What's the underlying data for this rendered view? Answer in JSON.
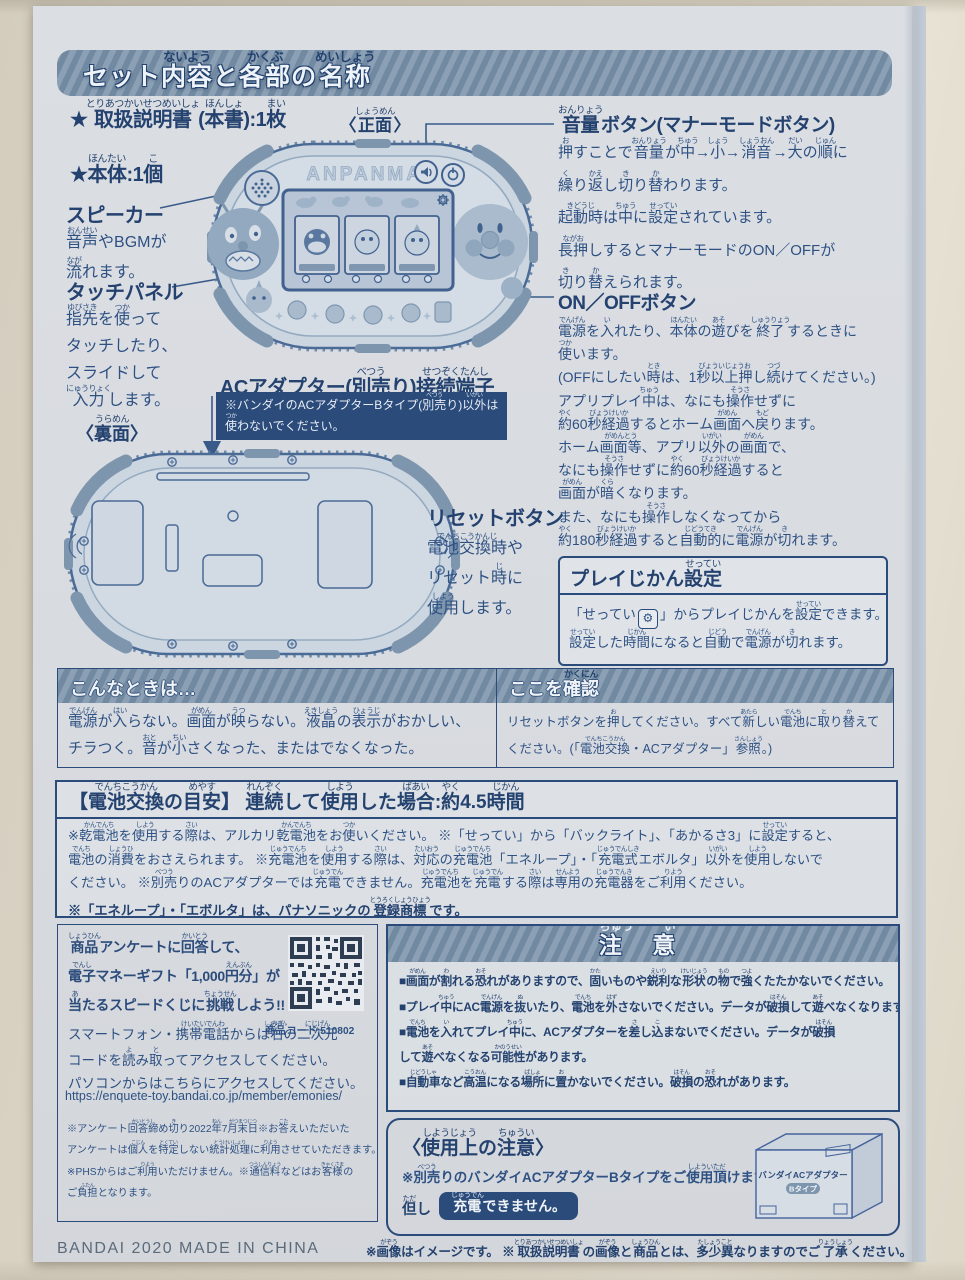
{
  "colors": {
    "paper": "#dbdee3",
    "ink": "#2e5183",
    "ink_dark": "#24426f",
    "bar_blue": "#7e95ab",
    "navy_box": "#2b4b7b",
    "photo_bg": "#ddd6c7"
  },
  "header": {
    "title": "セット{内容|ないよう}と{各部|かくぶ}の{名称|めいしょう}"
  },
  "contents": {
    "item1": "★{取扱説明書|とりあつかいせつめいしょ}({本書|ほんしょ}):1{枚|まい}",
    "item2": "★{本体|ほんたい}:1{個|こ}"
  },
  "front": {
    "caption": "〈{正面|しょうめん}〉",
    "logo": "ANPANMAN"
  },
  "speaker": {
    "label": "スピーカー",
    "desc": "{音声|おんせい}やBGMが\n{流|なが}れます。"
  },
  "touch": {
    "label": "タッチパネル",
    "desc": "{指先|ゆびさき}を{使|つか}って\nタッチしたり、\nスライドして\n{入力|にゅうりょく}します。"
  },
  "ac": {
    "label": "ACアダプター({別売|べつう}り){接続端子|せつぞくたんし}",
    "note": "※バンダイのACアダプターBタイプ({別売|べつう}り){以外|いがい}は\n{使|つか}わないでください。"
  },
  "back": {
    "caption": "〈{裏面|うらめん}〉"
  },
  "reset": {
    "label": "リセットボタン",
    "desc": "{電池交換時|でんちこうかんじ}や\nリセット{時|じ}に\n{使用|しよう}します。"
  },
  "volume": {
    "label": "{音量|おんりょう}ボタン(マナーモードボタン)",
    "desc": "{押|お}すことで{音量|おんりょう}が{中|ちゅう}→{小|しょう}→{消音|しょうおん}→{大|だい}の{順|じゅん}に\n{繰|く}り{返|かえ}し{切|き}り{替|か}わります。\n{起動時|きどうじ}は{中|ちゅう}に{設定|せってい}されています。\n{長押|ながお}しするとマナーモードのON／OFFが\n{切|き}り{替|か}えられます。"
  },
  "power": {
    "label": "ON／OFFボタン",
    "desc": "{電源|でんげん}を{入|い}れたり、{本体|ほんたい}の{遊|あそ}びを{終了|しゅうりょう}するときに\n{使|つか}います。\n(OFFにしたい{時|とき}は、1{秒以上押|びょういじょうお}し{続|つづ}けてください。)\nアプリプレイ{中|ちゅう}は、なにも{操作|そうさ}せずに\n{約|やく}60{秒経過|びょうけいか}するとホーム{画面|がめん}へ{戻|もど}ります。\nホーム{画面等|がめんとう}、アプリ{以外|いがい}の{画面|がめん}で、\nなにも{操作|そうさ}せずに{約|やく}60{秒経過|びょうけいか}すると\n{画面|がめん}が{暗|くら}くなります。\nまた、なにも{操作|そうさ}しなくなってから\n{約|やく}180{秒経過|びょうけいか}すると{自動的|じどうてき}に{電源|でんげん}が{切|き}れます。"
  },
  "playtime": {
    "title": "プレイじかん{設定|せってい}",
    "line1_pre": "「せってい",
    "gear_icon": "⚙",
    "line1_post": "」からプレイじかんを{設定|せってい}できます。",
    "line2": "{設定|せってい}した{時間|じかん}になると{自動|じどう}で{電源|でんげん}が{切|き}れます。"
  },
  "trouble": {
    "title": "こんなときは…",
    "body": "{電源|でんげん}が{入|はい}らない。{画面|がめん}が{映|うつ}らない。{液晶|えきしょう}の{表示|ひょうじ}がおかしい、\nチラつく。{音|おと}が{小|ちい}さくなった、またはでなくなった。"
  },
  "check": {
    "title": "ここを{確認|かくにん}",
    "body": "リセットボタンを{押|お}してください。すべて{新|あたら}しい{電池|でんち}に{取|と}り{替|か}えて\nください。(「{電池交換|でんちこうかん}・ACアダプター」{参照|さんしょう}。)"
  },
  "battery": {
    "title": "【{電池交換|でんちこうかん}の{目安|めやす}】 {連続|れんぞく}して{使用|しよう}した{場合|ばあい}:{約|やく}4.5{時間|じかん}",
    "body": "※{乾電池|かんでんち}を{使用|しよう}する{際|さい}は、アルカリ{乾電池|かんでんち}をお{使|つか}いください。 ※「せってい」から「バックライト」、「あかるさ3」に{設定|せってい}すると、\n{電池|でんち}の{消費|しょうひ}をおさえられます。 ※{充電池|じゅうでんち}を{使用|しよう}する{際|さい}は、{対応|たいおう}の{充電池|じゅうでんち}「エネループ」・「{充電式|じゅうでんしき}エボルタ」{以外|いがい}を{使用|しよう}しないで\nください。 ※{別売|べつう}りのACアダプターでは{充電|じゅうでん}できません。{充電池|じゅうでんち}を{充電|じゅうでん}する{際|さい}は{専用|せんよう}の{充電器|じゅうでんき}をご{利用|りよう}ください。",
    "note": "※「エネループ」・「エボルタ」は、パナソニックの{登録商標|とうろくしょうひょう}です。"
  },
  "survey": {
    "line1": "{商品|しょうひん}アンケートに{回答|かいとう}して、",
    "line2": "{電子|でんし}マネーギフト「1,000{円分|えんぶん}」が",
    "line3": "{当|あ}たるスピードくじに{挑戦|ちょうせん}しよう!!",
    "line4": "スマートフォン・{携帯電話|けいたいでんわ}からは{右|みぎ}の{二次元|にじげん}",
    "line5": "コードを{読|よ}み{取|と}ってアクセスしてください。",
    "line6": "パソコンからはこちらにアクセスしてください。",
    "url": "https://enquete-toy.bandai.co.jp/member/emonies/",
    "note1": "※アンケート{回答締|かいとうし}め{切|き}り2022{年|ねん}7{月末日|がつまつじつ}※お{答|こた}えいただいた",
    "note2": "アンケートは{個人|こじん}を{特定|とくてい}しない{統計処理|とうけいしょり}に{利用|りよう}させていただきます。",
    "note3": "※PHSからはご{利用|りよう}いただけません。※{通信料|つうしんりょう}などはお{客様|きゃくさま}の",
    "note4": "ご{負担|ふたん}となります。",
    "product_code": "{商品|しょうひん}コード:510802"
  },
  "caution": {
    "title": "{注|ちゅう} {意|い}",
    "item1": "■{画面|がめん}が{割|わ}れる{恐|おそ}れがありますので、{固|かた}いものや{鋭利|えいり}な{形状|けいじょう}の{物|もの}で{強|つよ}くたたかないでください。",
    "item2": "■プレイ{中|ちゅう}にAC{電源|でんげん}を{抜|ぬ}いたり、{電池|でんち}を{外|はず}さないでください。データが{破損|はそん}して{遊|あそ}べなくなります。",
    "item3": "■{電池|でんち}を{入|い}れてプレイ{中|ちゅう}に、ACアダプターを{差|さ}し{込|こ}まないでください。データが{破損|はそん}\n して{遊|あそ}べなくなる{可能性|かのうせい}があります。",
    "item4": "■{自動車|じどうしゃ}など{高温|こうおん}になる{場所|ばしょ}に{置|お}かないでください。{破損|はそん}の{恐|おそ}れがあります。"
  },
  "usage": {
    "title": "〈{使用上|しようじょう}の{注意|ちゅうい}〉",
    "line": "※{別売|べつう}りのバンダイACアダプターBタイプをご{使用頂|しよういただ}けます。",
    "tadashi": "{但|ただ}し",
    "badge": "{充電|じゅうでん}できません。",
    "box_line1": "バンダイACアダプター",
    "box_line2": "Bタイプ"
  },
  "footer": {
    "left": "BANDAI 2020 MADE IN CHINA",
    "right": "※{画像|がぞう}はイメージです。 ※{取扱説明書|とりあつかいせつめいしょ}の{画像|がぞう}と{商品|しょうひん}とは、{多少異|たしょうこと}なりますのでご{了承|りょうしょう}ください。"
  }
}
